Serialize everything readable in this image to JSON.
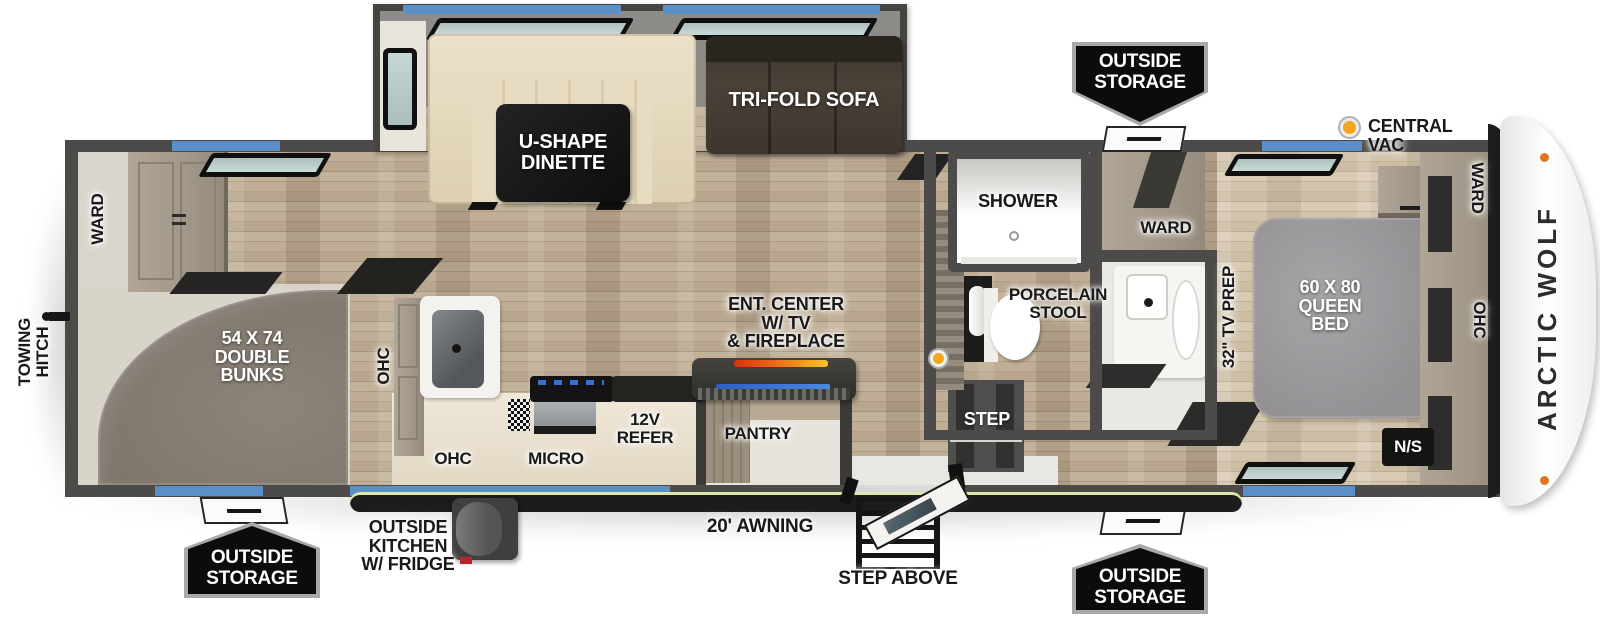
{
  "title": "Arctic Wolf fifth wheel floor plan",
  "colors": {
    "wall": "#4c4b49",
    "window_blue": "#5b8fc7",
    "badge_black": "#0c0c0c",
    "vac_yellow": "#f2a71f",
    "fireplace_orange": "#f07b1a",
    "tv_blue": "#3a6fd0",
    "bed_gray": "#9b999c",
    "floor_wood": "#b8a78e"
  },
  "rear": {
    "towing_hitch": "TOWING\nHITCH",
    "ward": "WARD",
    "bunks": "54 X 74\nDOUBLE\nBUNKS"
  },
  "slide_out": {
    "dinette": "U-SHAPE\nDINETTE",
    "sofa": "TRI-FOLD SOFA"
  },
  "kitchen": {
    "ohc_wall": "OHC",
    "ohc_counter": "OHC",
    "micro": "MICRO",
    "refer": "12V\nREFER",
    "pantry": "PANTRY"
  },
  "living": {
    "ent_center": "ENT. CENTER\nW/ TV\n& FIREPLACE"
  },
  "bath": {
    "shower": "SHOWER",
    "stool": "PORCELAIN\nSTOOL",
    "ward": "WARD",
    "step": "STEP"
  },
  "bedroom": {
    "tv_prep": "32\" TV PREP",
    "bed": "60 X 80\nQUEEN\nBED",
    "night_stand": "N/S",
    "ward": "WARD",
    "ohc": "OHC"
  },
  "exterior": {
    "central_vac": "CENTRAL VAC",
    "outside_storage_top": "OUTSIDE\nSTORAGE",
    "outside_storage_rear": "OUTSIDE\nSTORAGE",
    "outside_storage_front": "OUTSIDE\nSTORAGE",
    "outside_kitchen": "OUTSIDE\nKITCHEN\nW/ FRIDGE",
    "awning": "20' AWNING",
    "step_above": "STEP ABOVE",
    "brand": "ARCTIC WOLF"
  }
}
